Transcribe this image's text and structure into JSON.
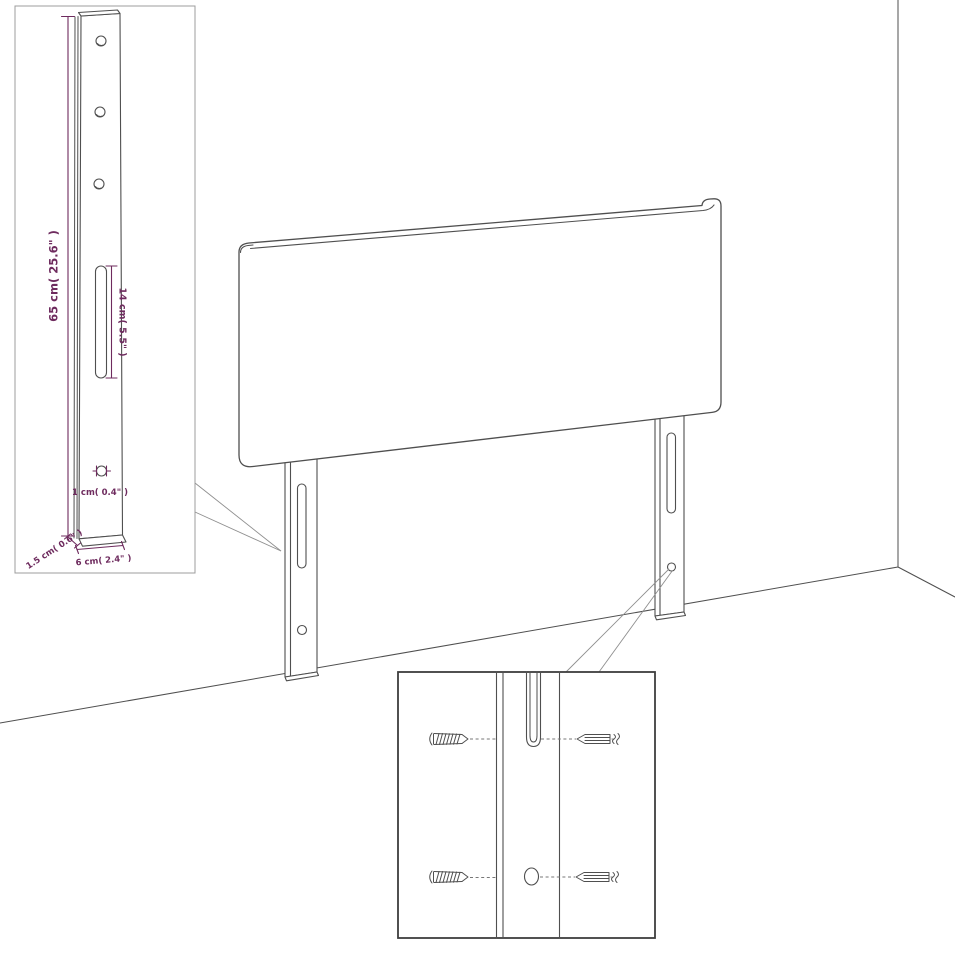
{
  "figure": {
    "title": "Headboard with wall-mount legs dimension diagram",
    "background": "#ffffff",
    "colors": {
      "line": "#4f4f4f",
      "dimension": "#6e2b5e",
      "callout": "#8f8f8f",
      "inset_border": "#9c9c9c",
      "detail_border": "#3e3e3e"
    },
    "inset": {
      "dimensions": {
        "height": "65 cm( 25.6\" )",
        "slot": "14 cm( 5.5\" )",
        "hole": "1 cm( 0.4\" )",
        "thickness": "1.5 cm( 0.6\" )",
        "width": "6 cm( 2.4\" )"
      }
    }
  }
}
